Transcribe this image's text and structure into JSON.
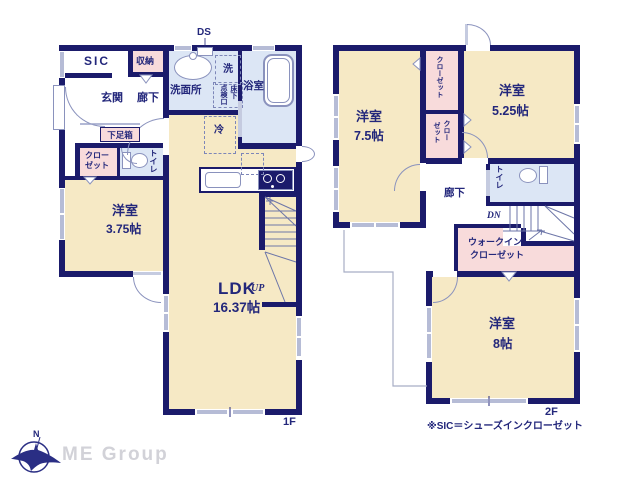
{
  "meta": {
    "floor1_label": "1F",
    "floor2_label": "2F",
    "note": "※SIC＝シューズインクローゼット"
  },
  "floor1": {
    "ds": "DS",
    "sic": "SIC",
    "storage": "収納",
    "entrance": "玄関",
    "hallway": "廊下",
    "shoe_box": "下足箱",
    "closet_line1": "クロー",
    "closet_line2": "ゼット",
    "toilet": "トイレ",
    "washroom": "洗面所",
    "washer": "洗",
    "hatch_main": "点検口",
    "hatch_sub": "床下",
    "bathroom": "浴室",
    "fridge": "冷",
    "room1_name": "洋室",
    "room1_size": "3.75帖",
    "ldk_name": "LDK",
    "ldk_size": "16.37帖",
    "up": "UP"
  },
  "floor2": {
    "closet_top": "クローゼット",
    "closet_bottom_line1": "クロー",
    "closet_bottom_line2": "ゼット",
    "room75_name": "洋室",
    "room75_size": "7.5帖",
    "room525_name": "洋室",
    "room525_size": "5.25帖",
    "toilet": "トイレ",
    "hallway": "廊下",
    "dn": "DN",
    "wic_line1": "ウォークイン",
    "wic_line2": "クローゼット",
    "room8_name": "洋室",
    "room8_size": "8帖"
  },
  "footer": {
    "compass_n": "N",
    "logo": "ME Group"
  },
  "colors": {
    "wall": "#1b1b6b",
    "room_fill": "#f6e9c5",
    "wet_fill": "#dce6f5",
    "closet_fill": "#f8dbdb",
    "line": "#8a92bd",
    "text": "#23277b"
  }
}
